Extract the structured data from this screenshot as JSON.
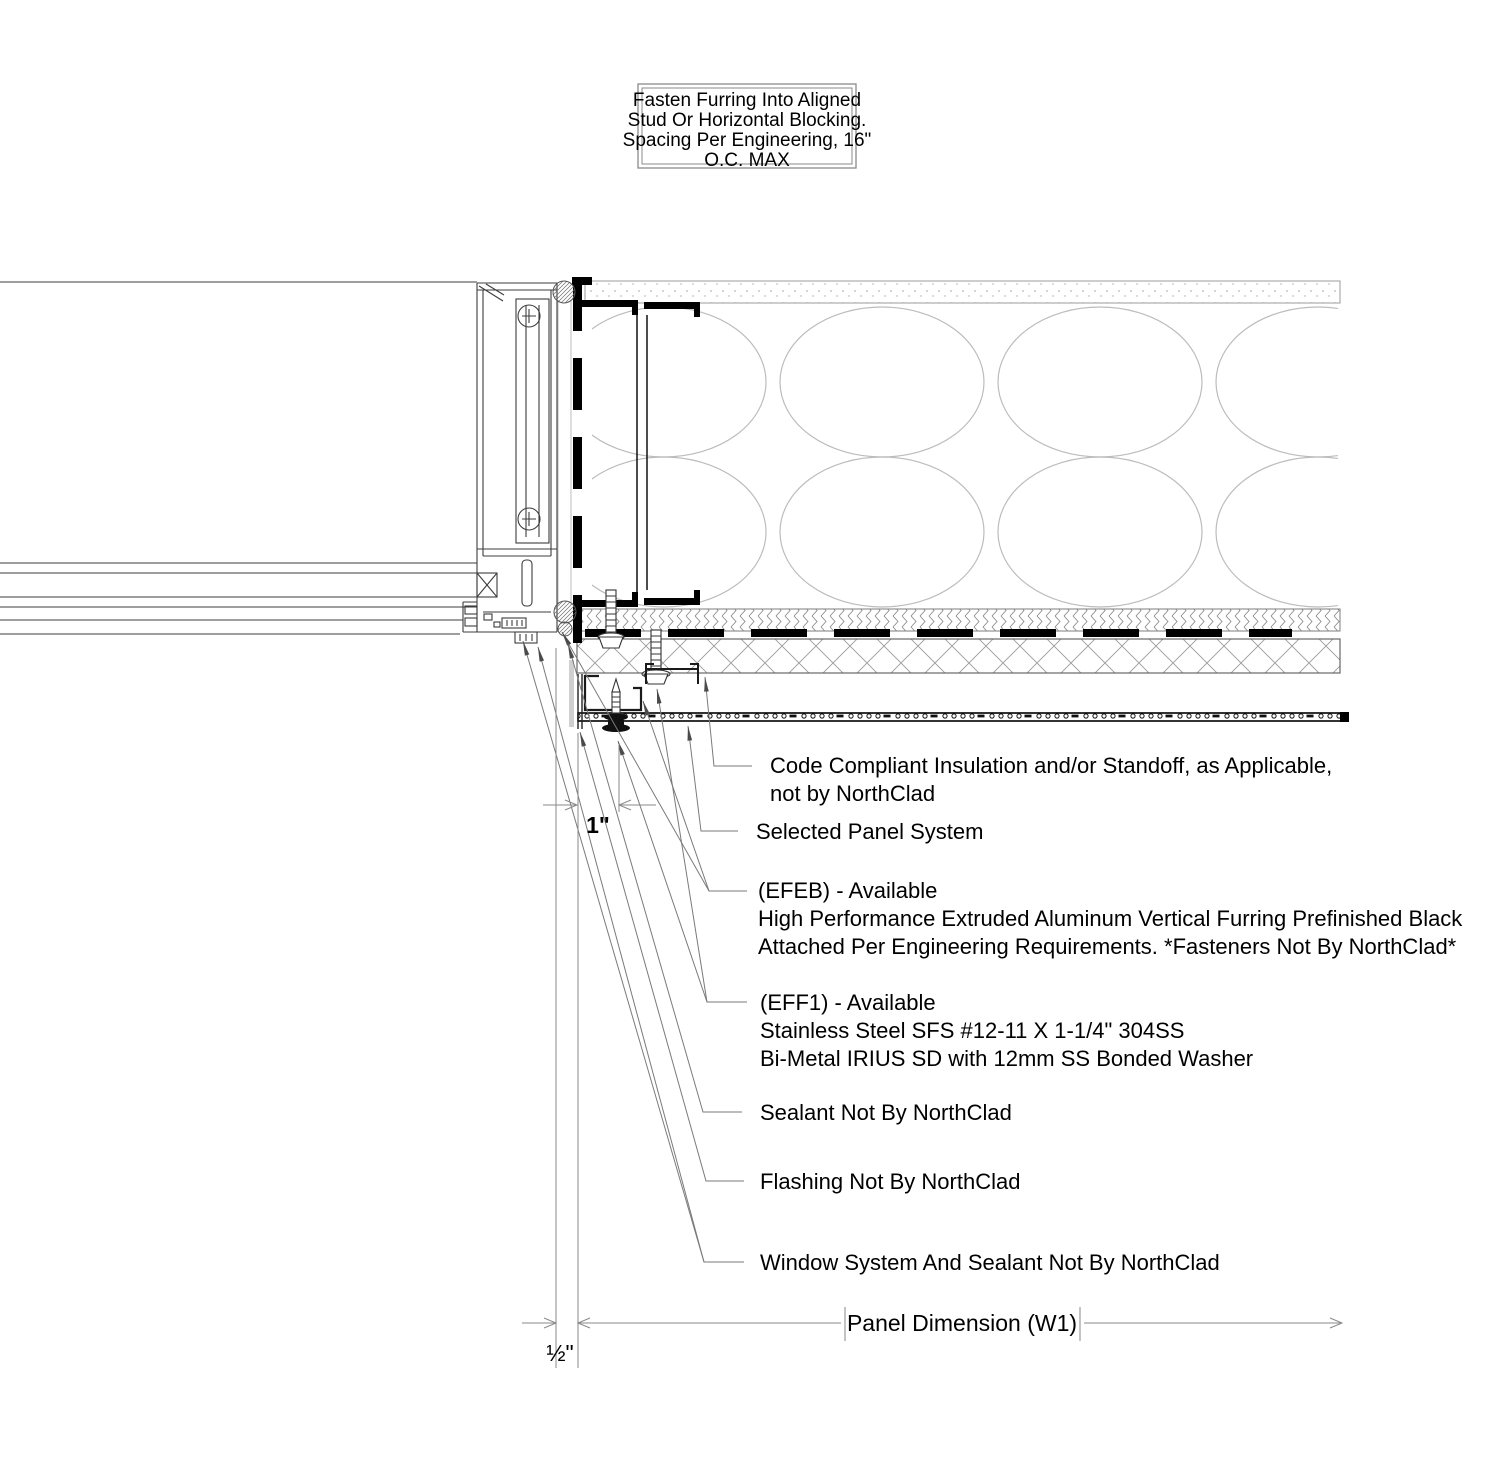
{
  "note_box": {
    "lines": [
      "Fasten Furring Into Aligned",
      "Stud Or Horizontal Blocking.",
      "Spacing Per Engineering, 16\"",
      "O.C. MAX"
    ]
  },
  "callouts": {
    "code_compliant": {
      "lines": [
        "Code Compliant Insulation and/or Standoff, as Applicable,",
        "not by NorthClad"
      ]
    },
    "selected_panel": {
      "label": "Selected Panel System"
    },
    "efeb": {
      "lines": [
        "(EFEB) - Available",
        "High Performance Extruded Aluminum Vertical Furring Prefinished Black",
        "Attached Per Engineering Requirements. *Fasteners Not By NorthClad*"
      ]
    },
    "eff1": {
      "lines": [
        "(EFF1) - Available",
        "Stainless Steel SFS #12-11 X 1-1/4\" 304SS",
        "Bi-Metal IRIUS SD with 12mm SS Bonded Washer"
      ]
    },
    "sealant": {
      "label": "Sealant Not By NorthClad"
    },
    "flashing": {
      "label": "Flashing Not By NorthClad"
    },
    "window_system": {
      "label": "Window System And Sealant Not By NorthClad"
    }
  },
  "dimensions": {
    "furring_depth": "1\"",
    "joint_width": "½\"",
    "panel_width": "Panel Dimension (W1)"
  },
  "colors": {
    "line_black": "#000000",
    "line_gray": "#9b9b9b",
    "leader_gray": "#7a7a7a",
    "batt_gray": "#bcbcbc"
  }
}
